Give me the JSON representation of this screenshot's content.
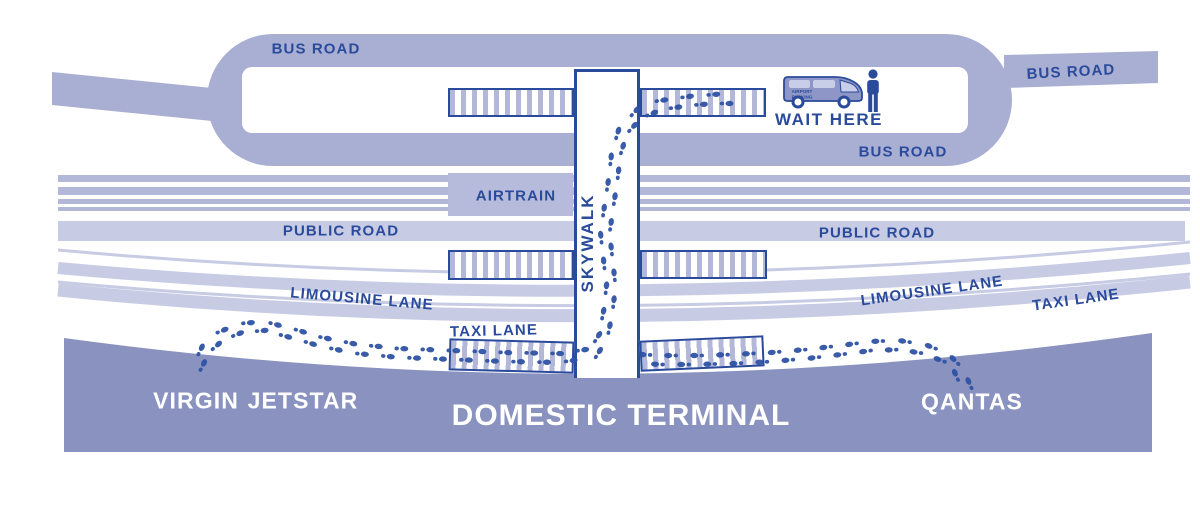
{
  "title": "Domestic Terminal transfer map",
  "colors": {
    "ink": "#2a4a9b",
    "road_main": "#a9aed3",
    "road_light": "#c7cbe4",
    "stripe": "#b3b8d9",
    "airtrain_box": "#b6bbdb",
    "terminal": "#8a92c0",
    "van_body": "#8d96c7",
    "van_window": "#c9cee8",
    "footprint": "#2e52a3"
  },
  "labels": {
    "bus_road_top": "BUS ROAD",
    "bus_road_inner": "BUS ROAD",
    "bus_road_right": "BUS ROAD",
    "public_road_left": "PUBLIC ROAD",
    "public_road_right": "PUBLIC ROAD",
    "limousine_lane_left": "LIMOUSINE LANE",
    "limousine_lane_right": "LIMOUSINE LANE",
    "taxi_lane_left": "TAXI LANE",
    "taxi_lane_right": "TAXI LANE",
    "airtrain": "AIRTRAIN",
    "skywalk": "SKYWALK",
    "wait_here": "WAIT HERE",
    "virgin": "VIRGIN",
    "jetstar": "JETSTAR",
    "qantas": "QANTAS",
    "domestic_terminal": "DOMESTIC TERMINAL"
  },
  "van": {
    "side_text_line1": "AIRPORT",
    "side_text_line2": "PARKING"
  },
  "footprint_trails": [
    {
      "name": "virgin-jetstar-to-bus-stop-via-skywalk",
      "points": [
        [
          197,
          367
        ],
        [
          206,
          349
        ],
        [
          221,
          336
        ],
        [
          241,
          328
        ],
        [
          264,
          326
        ],
        [
          291,
          333
        ],
        [
          322,
          342
        ],
        [
          357,
          349
        ],
        [
          400,
          353
        ],
        [
          452,
          355
        ],
        [
          506,
          357
        ],
        [
          558,
          358
        ],
        [
          593,
          353
        ],
        [
          603,
          337
        ],
        [
          608,
          312
        ],
        [
          611,
          286
        ],
        [
          608,
          259
        ],
        [
          605,
          233
        ],
        [
          609,
          206
        ],
        [
          613,
          180
        ],
        [
          616,
          154
        ],
        [
          623,
          131
        ],
        [
          639,
          114
        ],
        [
          661,
          105
        ],
        [
          689,
          101
        ],
        [
          714,
          99
        ],
        [
          737,
          99
        ]
      ]
    },
    {
      "name": "qantas-to-skywalk",
      "points": [
        [
          967,
          389
        ],
        [
          959,
          371
        ],
        [
          945,
          357
        ],
        [
          924,
          349
        ],
        [
          899,
          345
        ],
        [
          871,
          346
        ],
        [
          841,
          350
        ],
        [
          807,
          354
        ],
        [
          771,
          357
        ],
        [
          734,
          359
        ],
        [
          697,
          360
        ],
        [
          661,
          360
        ],
        [
          642,
          359
        ]
      ]
    }
  ]
}
